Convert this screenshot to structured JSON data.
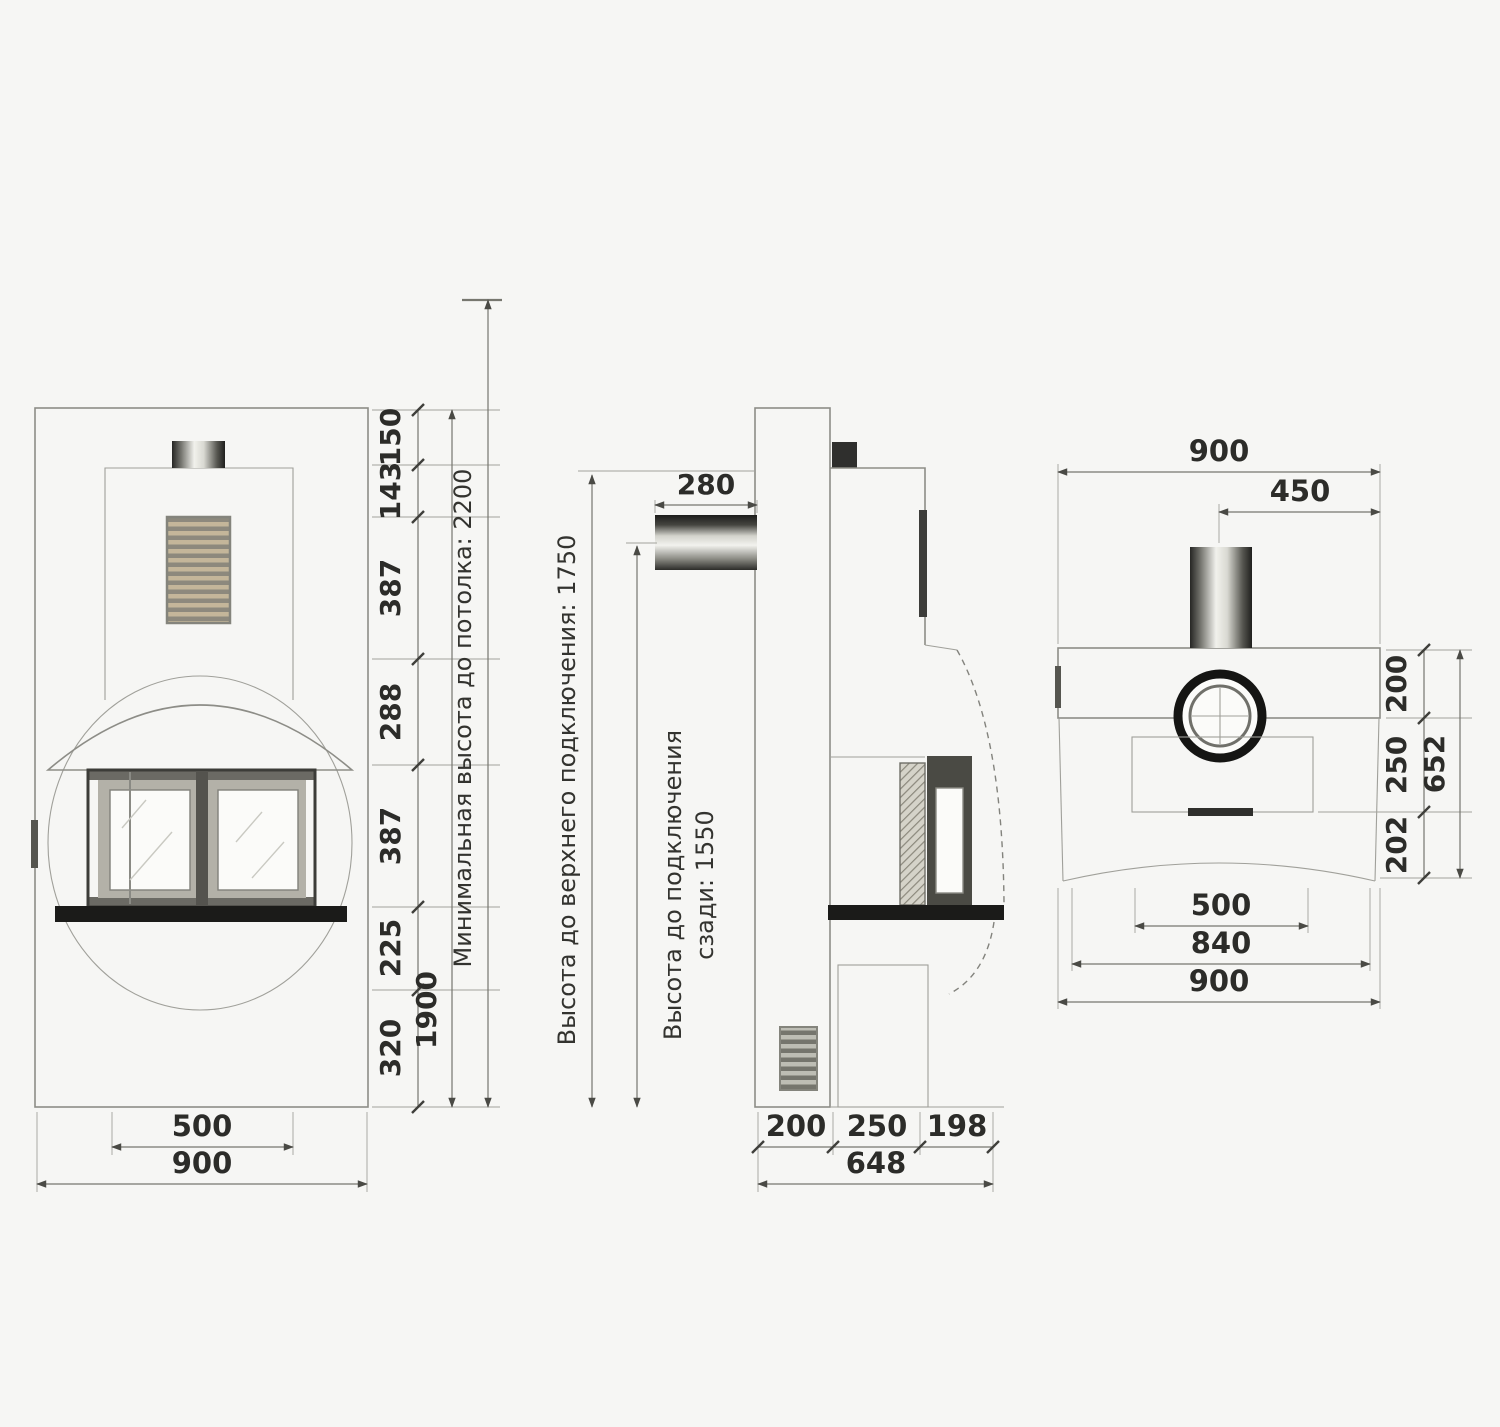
{
  "front_view": {
    "chain": [
      "150",
      "143",
      "387",
      "288",
      "387",
      "225",
      "320"
    ],
    "total_height": "1900",
    "ceiling_note": "Минимальная высота до потолка: 2200",
    "hearth_width": "500",
    "overall_width": "900"
  },
  "side_view": {
    "pipe_diameter": "280",
    "top_connection_note": "Высота до верхнего подключения: 1750",
    "rear_connection_note_line1": "Высота до подключения",
    "rear_connection_note_line2": "сзади: 1550",
    "depth_chain": [
      "200",
      "250",
      "198"
    ],
    "depth_total": "648"
  },
  "top_view": {
    "overall_width_top": "900",
    "flue_offset": "450",
    "depth_chain": [
      "200",
      "250",
      "202"
    ],
    "depth_total": "652",
    "hearth_width": "500",
    "body_width": "840",
    "overall_width_bottom": "900"
  }
}
